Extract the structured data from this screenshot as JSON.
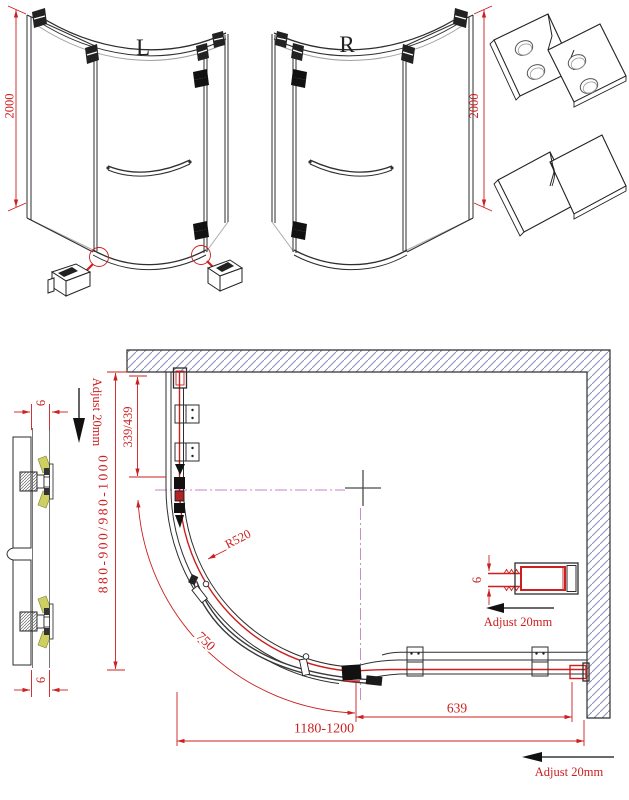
{
  "colors": {
    "dimension_red": "#cc1f1f",
    "hatch_blue": "#8891b8",
    "centerline_magenta": "#c77fc7",
    "wedge_yellow": "#cdd061",
    "linework": "#2e2e2e"
  },
  "elevation_views": {
    "left": {
      "label": "L",
      "height_dim": "2000"
    },
    "right": {
      "label": "R",
      "height_dim": "2000"
    }
  },
  "plan_view": {
    "adjust_top_left": "Adjust 20mm",
    "adjust_mid_right": "Adjust 20mm",
    "adjust_bottom_right": "Adjust 20mm",
    "dim_wall_to_door_axis": "339/439",
    "dim_depth_range": "880-900/980-1000",
    "dim_door_radius": "R520",
    "dim_door_arc_width": "750",
    "dim_total_width_range": "1180-1200",
    "dim_handle_to_wall": "639",
    "glass_thickness_top": "6",
    "glass_thickness_bottom": "6",
    "glass_thickness_right": "6"
  }
}
